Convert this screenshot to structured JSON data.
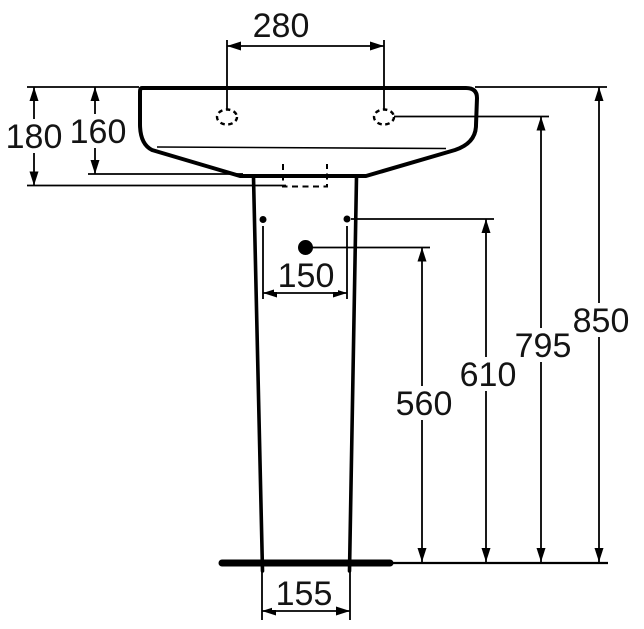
{
  "colors": {
    "line": "#000000",
    "background": "#ffffff",
    "text": "#141414"
  },
  "labels": {
    "tap_hole_spacing": "280",
    "basin_total_height": "180",
    "basin_front_height": "160",
    "pedestal_hole_spacing": "150",
    "pedestal_base_width": "155",
    "bottom_hole_height": "560",
    "side_hole_height": "610",
    "tap_hole_height": "795",
    "rim_height": "850"
  }
}
